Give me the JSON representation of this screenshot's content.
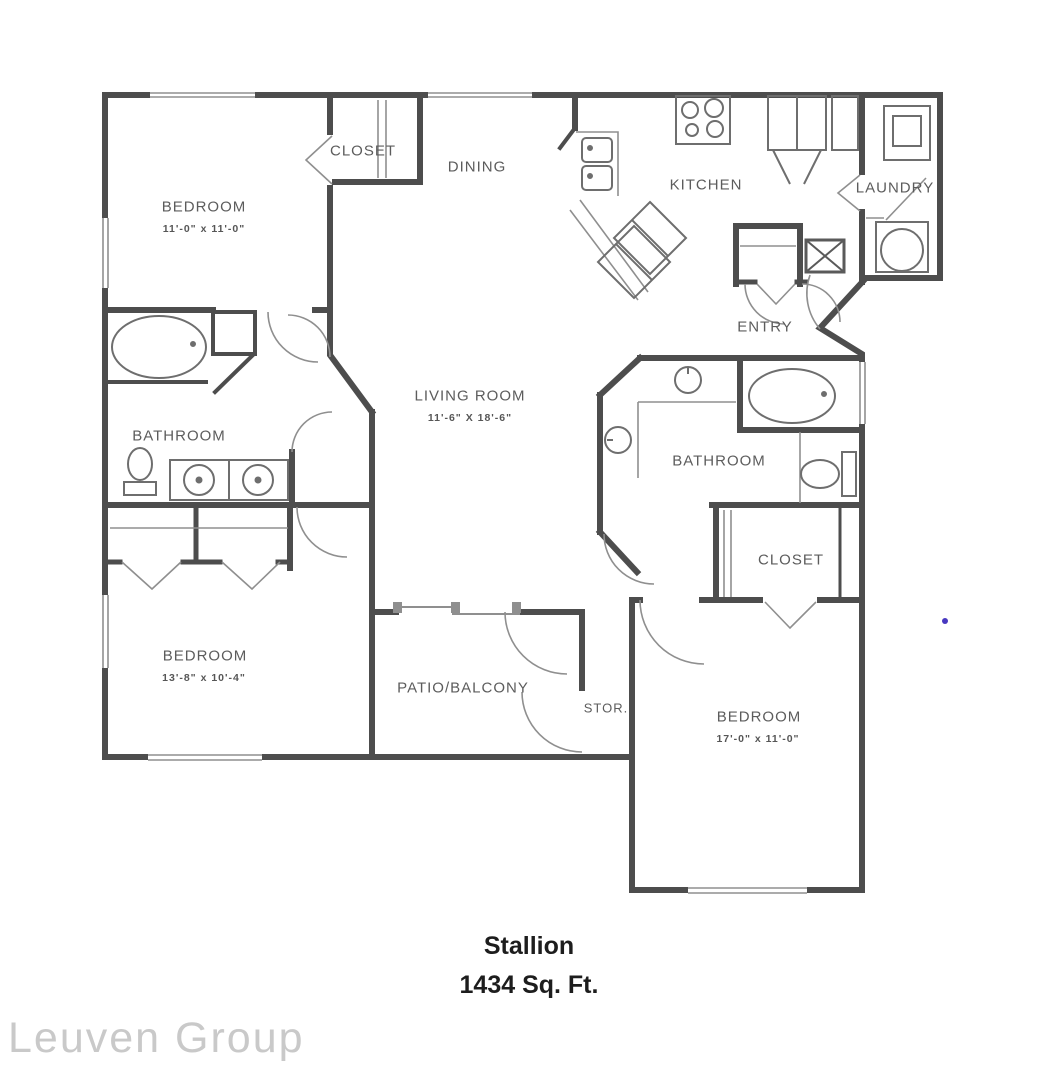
{
  "plan": {
    "title": "Stallion",
    "subtitle": "1434 Sq. Ft.",
    "watermark": "Leuven Group"
  },
  "rooms": {
    "bedroom1": {
      "label": "BEDROOM",
      "dims": "11'-0\" x 11'-0\""
    },
    "closet1": {
      "label": "CLOSET"
    },
    "dining": {
      "label": "DINING"
    },
    "kitchen": {
      "label": "KITCHEN"
    },
    "laundry": {
      "label": "LAUNDRY"
    },
    "entry": {
      "label": "ENTRY"
    },
    "living": {
      "label": "LIVING ROOM",
      "dims": "11'-6\" X 18'-6\""
    },
    "bathroom1": {
      "label": "BATHROOM"
    },
    "bedroom2": {
      "label": "BEDROOM",
      "dims": "13'-8\" x 10'-4\""
    },
    "patio": {
      "label": "PATIO/BALCONY"
    },
    "storage": {
      "label": "STOR."
    },
    "bathroom2": {
      "label": "BATHROOM"
    },
    "closet2": {
      "label": "CLOSET"
    },
    "bedroom3": {
      "label": "BEDROOM",
      "dims": "17'-0\" x 11'-0\""
    }
  },
  "colors": {
    "wall": "#4d4d4d",
    "thin_line": "#8f8f8f",
    "fixture": "#6e6e6e",
    "label": "#5c5c5c",
    "title": "#1d1d1d",
    "watermark": "#c9c9c9",
    "dot": "#4838c0"
  }
}
